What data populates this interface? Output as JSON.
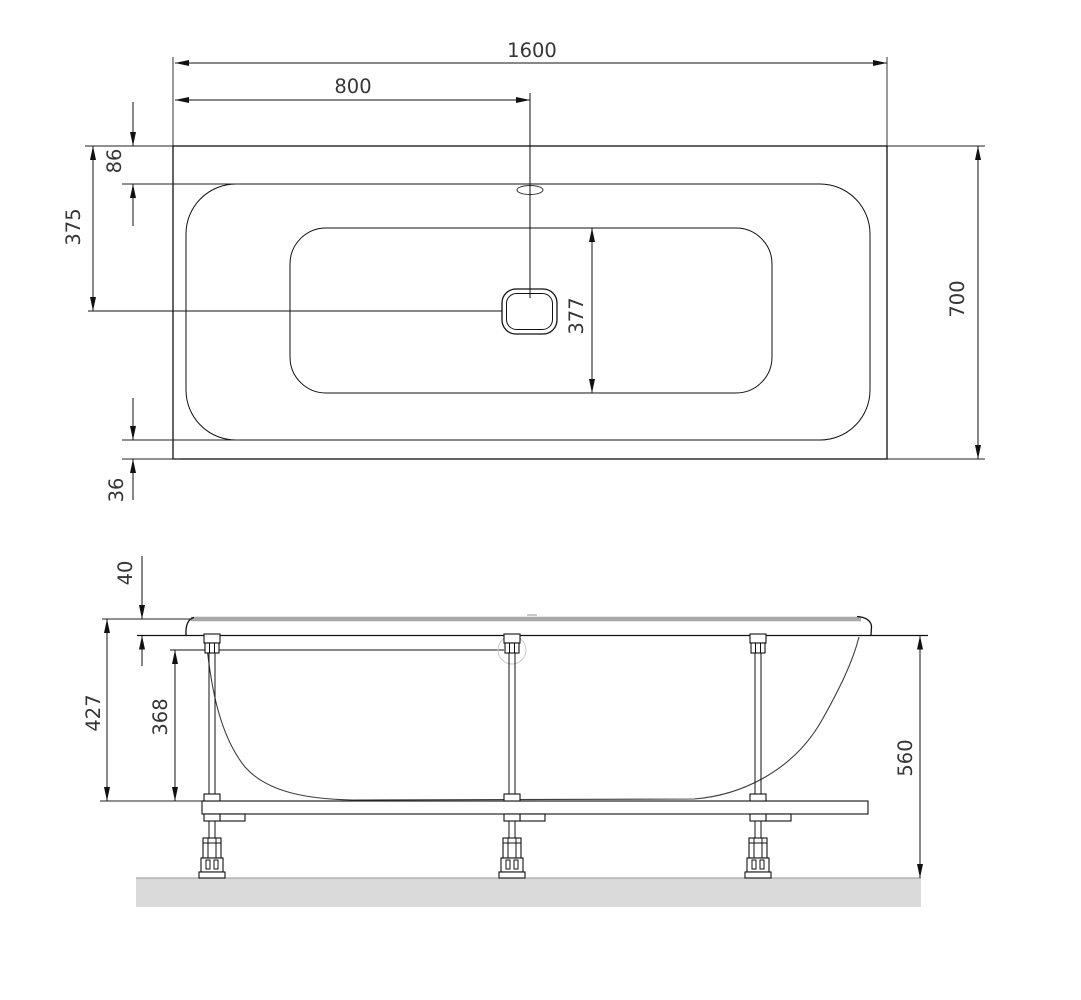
{
  "plan_view": {
    "overall_length_mm": "1600",
    "drain_center_from_left_mm": "800",
    "top_rim_width_mm": "86",
    "drain_center_from_top_mm": "375",
    "bottom_rim_width_mm": "36",
    "basin_inner_width_mm": "377",
    "overall_width_mm": "700"
  },
  "side_view": {
    "rim_thickness_mm": "40",
    "rim_to_frame_bottom_mm": "427",
    "leg_clear_height_mm": "368",
    "underside_to_floor_mm": "560"
  }
}
